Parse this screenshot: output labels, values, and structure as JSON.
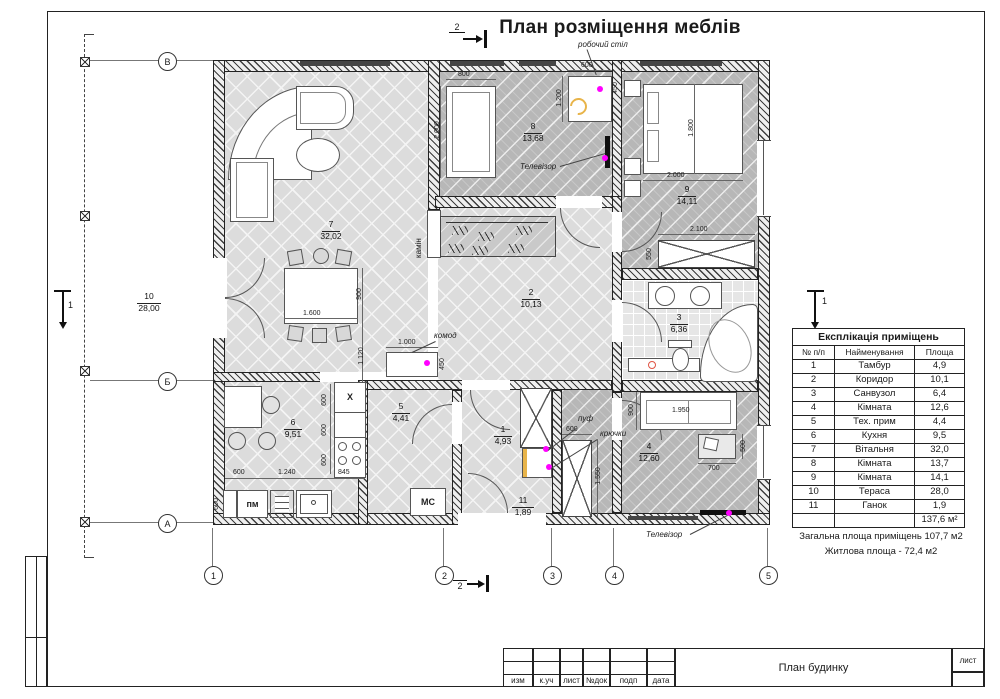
{
  "page": {
    "title": "План розміщення меблів"
  },
  "axes": {
    "cols": [
      "1",
      "2",
      "3",
      "4",
      "5"
    ],
    "rows": [
      "В",
      "Б",
      "А"
    ]
  },
  "sections": {
    "s1": "1",
    "s2": "2"
  },
  "rooms": {
    "r1": {
      "num": "1",
      "area": "4,93"
    },
    "r2": {
      "num": "2",
      "area": "10,13"
    },
    "r3": {
      "num": "3",
      "area": "6,36"
    },
    "r4": {
      "num": "4",
      "area": "12,60"
    },
    "r5": {
      "num": "5",
      "area": "4,41"
    },
    "r6": {
      "num": "6",
      "area": "9,51"
    },
    "r7": {
      "num": "7",
      "area": "32,02"
    },
    "r8": {
      "num": "8",
      "area": "13,68"
    },
    "r9": {
      "num": "9",
      "area": "14,11"
    },
    "r10": {
      "num": "10",
      "area": "28,00"
    },
    "r11": {
      "num": "11",
      "area": "1,89"
    }
  },
  "annotations": {
    "work_desk": "робочий стіл",
    "tv": "Телевізор",
    "fireplace": "камін",
    "dresser": "комод",
    "pouf": "пуф",
    "hooks": "крючки",
    "dishwasher": "пм",
    "washing_machine": "МС",
    "hood": "Х"
  },
  "dims": {
    "d450": "450",
    "d500": "500",
    "d550": "550",
    "d600": "600",
    "d700": "700",
    "d800": "800",
    "d845": "845",
    "d900": "900",
    "d1000": "1.000",
    "d1120": "1.120",
    "d1200": "1.200",
    "d1240": "1.240",
    "d1550": "1.550",
    "d1600": "1.600",
    "d1800": "1.800",
    "d1950": "1.950",
    "d2000": "2.000",
    "d2100": "2.100"
  },
  "table": {
    "title": "Експлікація приміщень",
    "headers": [
      "№ п/п",
      "Найменування",
      "Площа"
    ],
    "rows": [
      [
        "1",
        "Тамбур",
        "4,9"
      ],
      [
        "2",
        "Коридор",
        "10,1"
      ],
      [
        "3",
        "Санвузол",
        "6,4"
      ],
      [
        "4",
        "Кімната",
        "12,6"
      ],
      [
        "5",
        "Тех. прим",
        "4,4"
      ],
      [
        "6",
        "Кухня",
        "9,5"
      ],
      [
        "7",
        "Вітальня",
        "32,0"
      ],
      [
        "8",
        "Кімната",
        "13,7"
      ],
      [
        "9",
        "Кімната",
        "14,1"
      ],
      [
        "10",
        "Тераса",
        "28,0"
      ],
      [
        "11",
        "Ганок",
        "1,9"
      ]
    ],
    "total": "137,6 м²"
  },
  "summary": {
    "line1": "Загальна площа приміщень 107,7 м2",
    "line2": "Житлова площа - 72,4 м2"
  },
  "title_block": {
    "cells": [
      "изм",
      "к.уч",
      "лист",
      "№док",
      "подп",
      "дата"
    ],
    "doc_name": "План будинку",
    "sheet_label": "лист"
  },
  "colors": {
    "outlet": "#ff00ff",
    "chair_accent": "#e8b44a",
    "alert": "#e05545"
  }
}
